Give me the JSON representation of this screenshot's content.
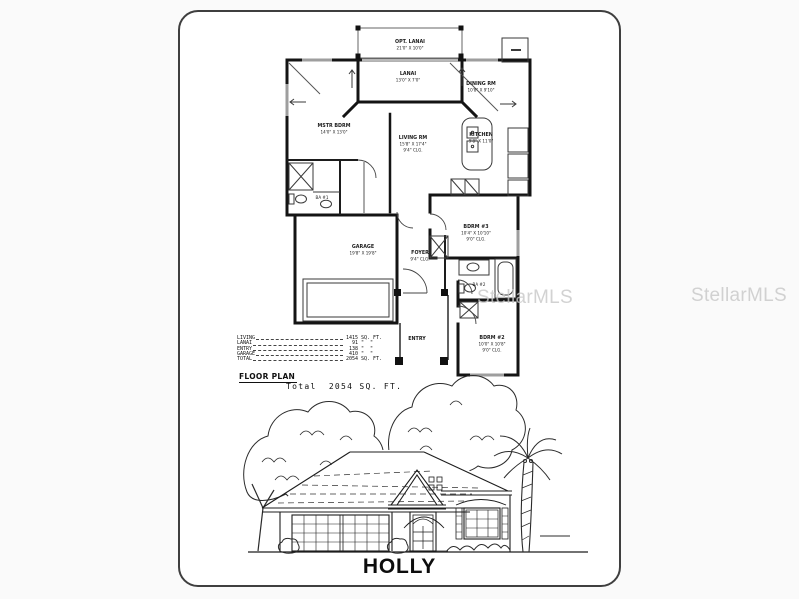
{
  "watermark": {
    "text": "StellarMLS"
  },
  "title": "HOLLY",
  "plan": {
    "rooms": {
      "opt_lanai": {
        "name": "OPT. LANAI",
        "dims": "21'0\" X 10'0\""
      },
      "lanai": {
        "name": "LANAI",
        "dims": "13'0\" X 7'0\""
      },
      "dining": {
        "name": "DINING RM",
        "dims": "10'8\" X 9'10\""
      },
      "mstr": {
        "name": "MSTR BDRM",
        "dims": "14'0\" X 13'0\""
      },
      "living": {
        "name": "LIVING RM",
        "dims": "15'8\" X 17'4\"",
        "clg": "9'4\" CLG."
      },
      "kitchen": {
        "name": "KITCHEN",
        "dims": "9'8\" X 11'0\""
      },
      "ba1": {
        "name": "BA #1"
      },
      "bdrm3": {
        "name": "BDRM #3",
        "dims": "10'4\" X 10'10\"",
        "clg": "9'0\" CLG."
      },
      "garage": {
        "name": "GARAGE",
        "dims": "19'8\" X 19'8\""
      },
      "foyer": {
        "name": "FOYER",
        "clg": "9'4\" CLG."
      },
      "ba2": {
        "name": "BA #2"
      },
      "entry": {
        "name": "ENTRY"
      },
      "bdrm2": {
        "name": "BDRM #2",
        "dims": "10'0\" X 10'8\"",
        "clg": "9'0\" CLG."
      }
    }
  },
  "area_table": {
    "rows": [
      {
        "label": "LIVING",
        "value": "1415",
        "unit": "SQ. FT."
      },
      {
        "label": "LANAI",
        "value": "91",
        "unit": "\"  \""
      },
      {
        "label": "ENTRY",
        "value": "138",
        "unit": "\"  \""
      },
      {
        "label": "GARAGE",
        "value": "410",
        "unit": "\"  \""
      },
      {
        "label": "TOTAL",
        "value": "2054",
        "unit": "SQ. FT."
      }
    ],
    "heading": "FLOOR PLAN",
    "total_line": "Total  2054 SQ. FT."
  }
}
